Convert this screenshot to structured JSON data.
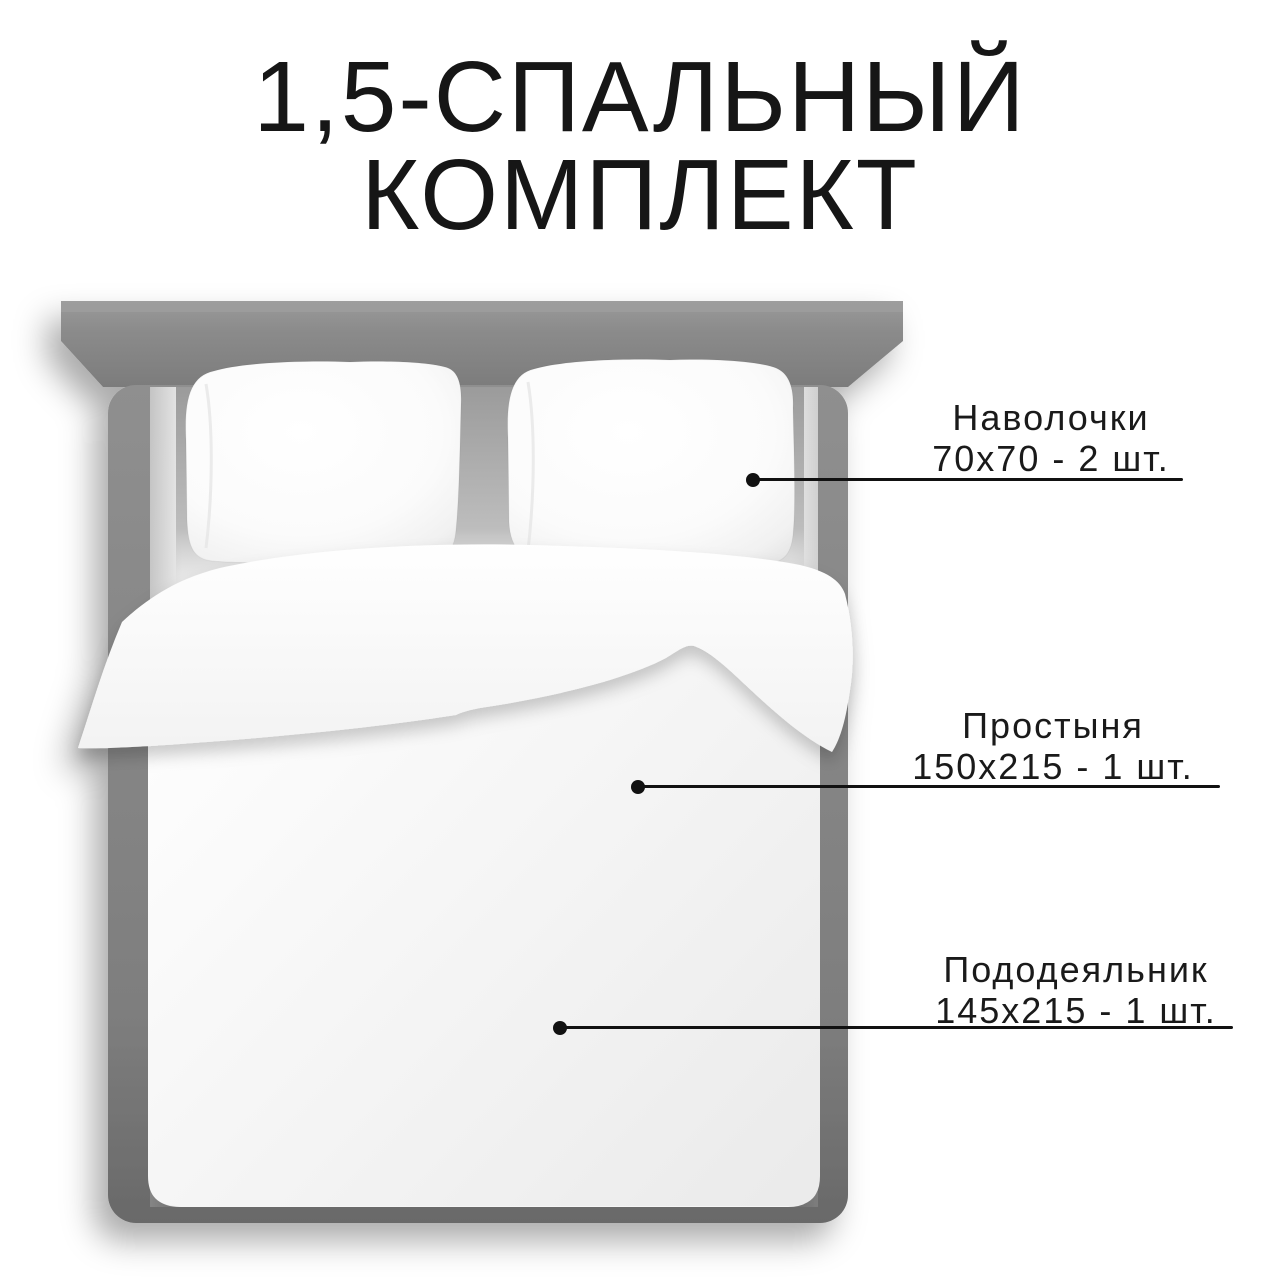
{
  "title": {
    "line1": "1,5-СПАЛЬНЫЙ",
    "line2": "КОМПЛЕКТ"
  },
  "callouts": [
    {
      "id": "pillowcases",
      "name": "Наволочки",
      "size": "70х70 - 2 шт."
    },
    {
      "id": "sheet",
      "name": "Простыня",
      "size": "150х215 - 1 шт."
    },
    {
      "id": "duvet_cover",
      "name": "Пододеяльник",
      "size": "145х215 - 1 шт."
    }
  ],
  "colors": {
    "background": "#ffffff",
    "text": "#1a1a1a",
    "callout_line": "#111111",
    "headboard": "#8c8c8c",
    "bed_frame": "#7d7d7d",
    "linen": "#ffffff"
  }
}
